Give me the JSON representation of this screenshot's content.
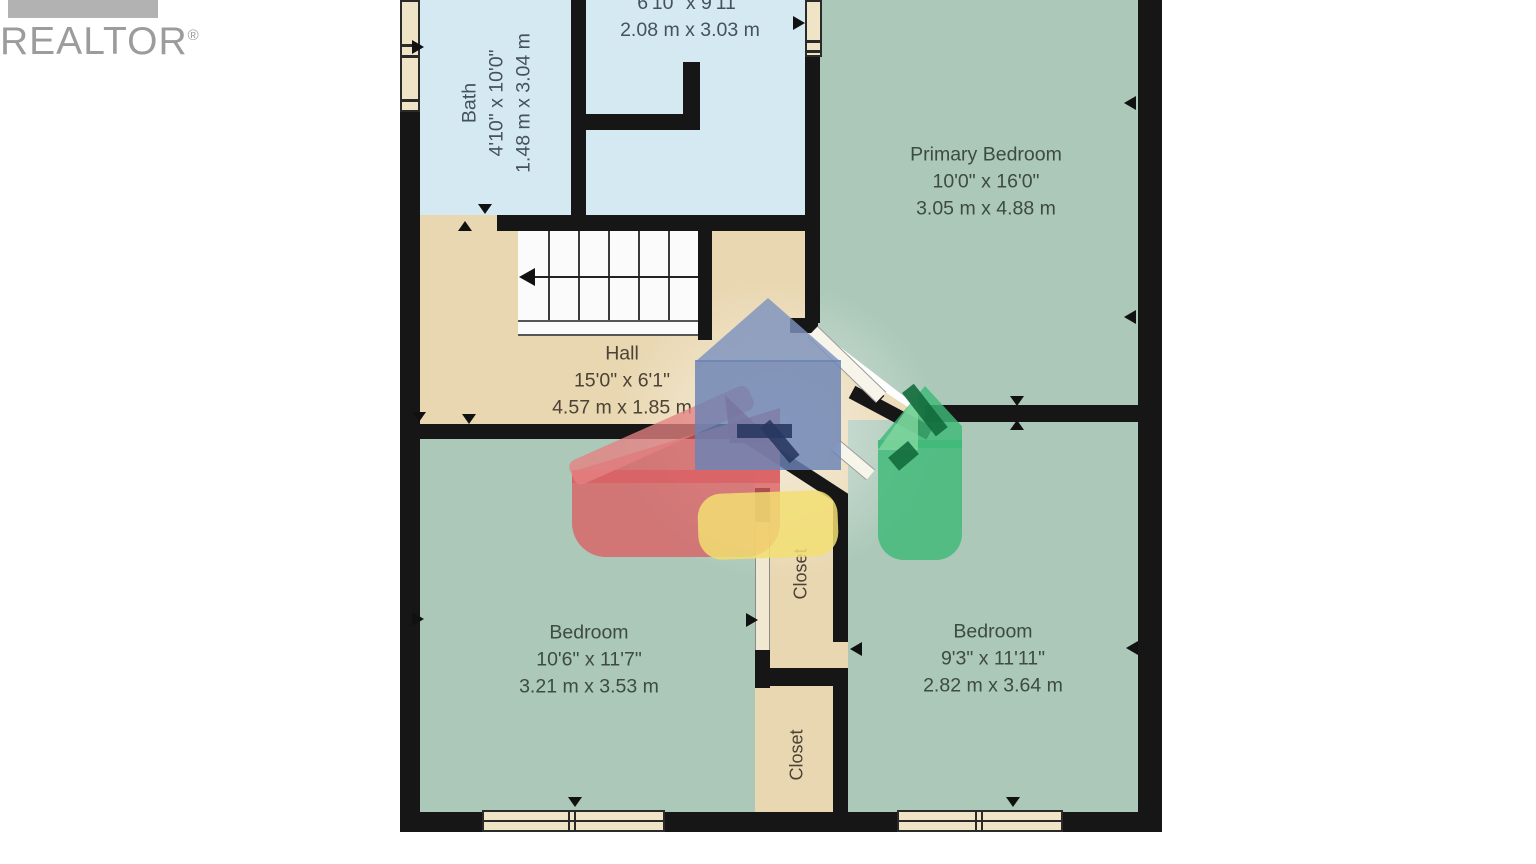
{
  "branding": {
    "realtor_text": "REALTOR",
    "registered_mark": "®"
  },
  "colors": {
    "wall": "#161616",
    "room_green": "#abc8b8",
    "room_blue": "#d5e9f3",
    "floor_tan": "#e9d7b1",
    "window_frame": "#f0e4c6",
    "stair_white": "#fbfbfb",
    "door_white": "#f7f4ea",
    "logo_gray": "#9c9c9c",
    "watermark_blue": "#6a82b4",
    "watermark_red": "#db5f63",
    "watermark_green": "#3eba78",
    "watermark_yellow": "#f2de72"
  },
  "rooms": [
    {
      "id": "bath",
      "name": "Bath",
      "dims_imperial": "4'10\" x 10'0\"",
      "dims_metric": "1.48 m x 3.04 m"
    },
    {
      "id": "top-middle-room",
      "name": "",
      "dims_imperial": "6'10\" x 9'11\"",
      "dims_metric": "2.08 m x 3.03 m"
    },
    {
      "id": "primary-bedroom",
      "name": "Primary Bedroom",
      "dims_imperial": "10'0\" x 16'0\"",
      "dims_metric": "3.05 m x 4.88 m"
    },
    {
      "id": "hall",
      "name": "Hall",
      "dims_imperial": "15'0\" x 6'1\"",
      "dims_metric": "4.57 m x 1.85 m"
    },
    {
      "id": "bedroom-left",
      "name": "Bedroom",
      "dims_imperial": "10'6\" x 11'7\"",
      "dims_metric": "3.21 m x 3.53 m"
    },
    {
      "id": "bedroom-right",
      "name": "Bedroom",
      "dims_imperial": "9'3\" x 11'11\"",
      "dims_metric": "2.82 m x 3.64 m"
    },
    {
      "id": "closet-upper",
      "name": "Closet"
    },
    {
      "id": "closet-lower",
      "name": "Closet"
    }
  ]
}
